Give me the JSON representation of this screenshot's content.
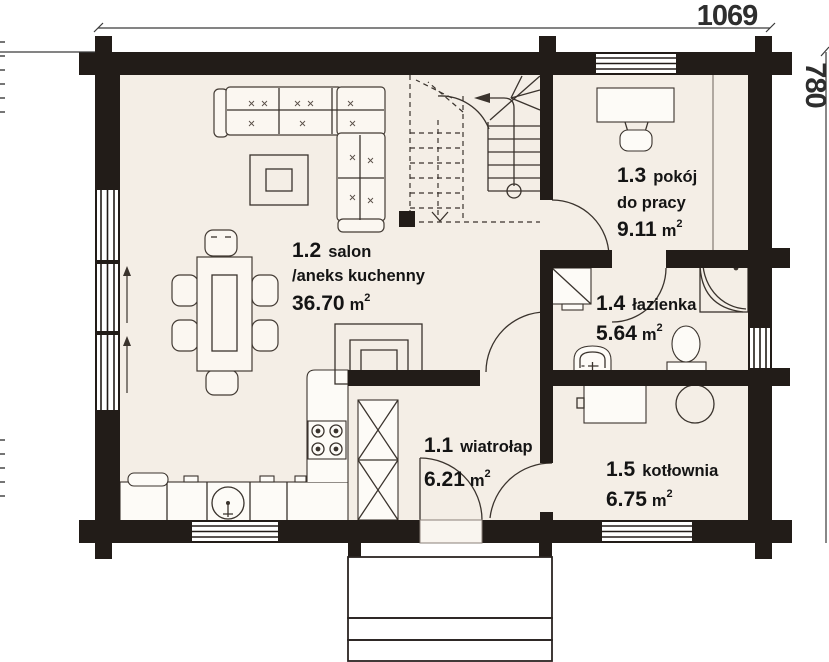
{
  "title": "floor-plan-parter",
  "dimensions": {
    "width_label": "1069",
    "height_label": "780"
  },
  "rooms": [
    {
      "id": "1.2",
      "name": "salon",
      "name2": "/aneks kuchenny",
      "area": "36.70",
      "unit": "m",
      "sup": "2"
    },
    {
      "id": "1.3",
      "name": "pokój",
      "name2": "do pracy",
      "area": "9.11",
      "unit": "m",
      "sup": "2"
    },
    {
      "id": "1.4",
      "name": "łazienka",
      "area": "5.64",
      "unit": "m",
      "sup": "2"
    },
    {
      "id": "1.1",
      "name": "wiatrołap",
      "area": "6.21",
      "unit": "m",
      "sup": "2"
    },
    {
      "id": "1.5",
      "name": "kotłownia",
      "area": "6.75",
      "unit": "m",
      "sup": "2"
    }
  ],
  "icons": [
    "sofa-icon",
    "coffee-table-icon",
    "dining-table-icon",
    "chair-icon",
    "desk-icon",
    "stairs-icon",
    "fireplace-icon",
    "chimney-shaft-icon",
    "vent-shaft-icon",
    "kitchen-counter-icon",
    "sink-icon",
    "stove-icon",
    "shower-icon",
    "washbasin-icon",
    "toilet-icon",
    "boiler-icon",
    "door-arc-icon",
    "window-icon",
    "entry-steps-icon"
  ],
  "colors": {
    "wall": "#221c18",
    "floor": "#f4eee6",
    "background": "#ffffff",
    "furniture_line": "#433b34",
    "text": "#141414",
    "dim_text": "#2e2e2e"
  }
}
